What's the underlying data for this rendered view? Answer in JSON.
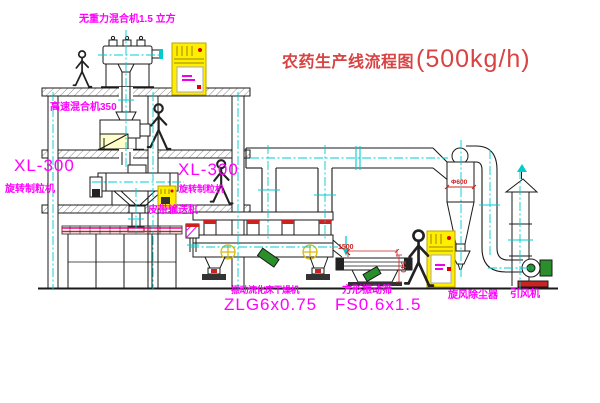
{
  "diagram": {
    "title_text": "农药生产线流程图",
    "title_capacity": "(500kg/h)",
    "labels": {
      "gravity_mixer": "无重力混合机1.5 立方",
      "high_speed_mixer": "高速混合机350",
      "granulator_left_model": "XL-300",
      "granulator_left_name": "旋转制粒机",
      "granulator_mid_model": "XL-300",
      "granulator_mid_name": "旋转制粒机",
      "belt_conveyor": "皮带输送机",
      "dryer_name": "振动流化床干燥机",
      "dryer_model": "ZLG6x0.75",
      "screen_name": "方形振动筛",
      "screen_model": "FS0.6x1.5",
      "cyclone": "旋风除尘器",
      "fan": "引风机"
    },
    "dimensions": {
      "screen_length": "1500",
      "screen_height": "540",
      "cyclone_diameter": "Φ600"
    },
    "colors": {
      "label_magenta": "#ff00ff",
      "title_red": "#d84343",
      "dimension_red": "#cc2222",
      "centerline_cyan": "#00cccc",
      "cabinet_yellow": "#ffee00",
      "motor_green": "#2a8f2a",
      "line_black": "#1a1a1a",
      "background": "#ffffff"
    }
  }
}
